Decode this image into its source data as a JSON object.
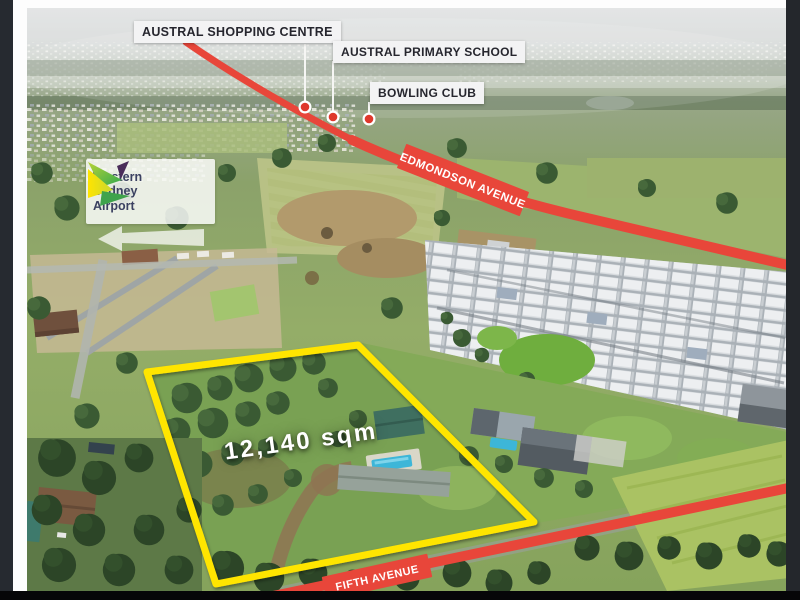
{
  "photo": {
    "area_label": "12,140 sqm",
    "poi_labels": [
      {
        "label": "AUSTRAL SHOPPING CENTRE"
      },
      {
        "label": "AUSTRAL PRIMARY SCHOOL"
      },
      {
        "label": "BOWLING CLUB"
      }
    ],
    "roads": {
      "edmondson": "EDMONDSON AVENUE",
      "fifth": "FIFTH AVENUE"
    },
    "logo": {
      "line1": "Western",
      "line2": "Sydney",
      "line3": "Airport"
    },
    "colors": {
      "road": "#e8463a",
      "boundary": "#ffe500",
      "marker": "#df382c",
      "label_bg": "#f3f3f4",
      "label_text": "#26262e",
      "logo_text": "#3b4161"
    }
  }
}
